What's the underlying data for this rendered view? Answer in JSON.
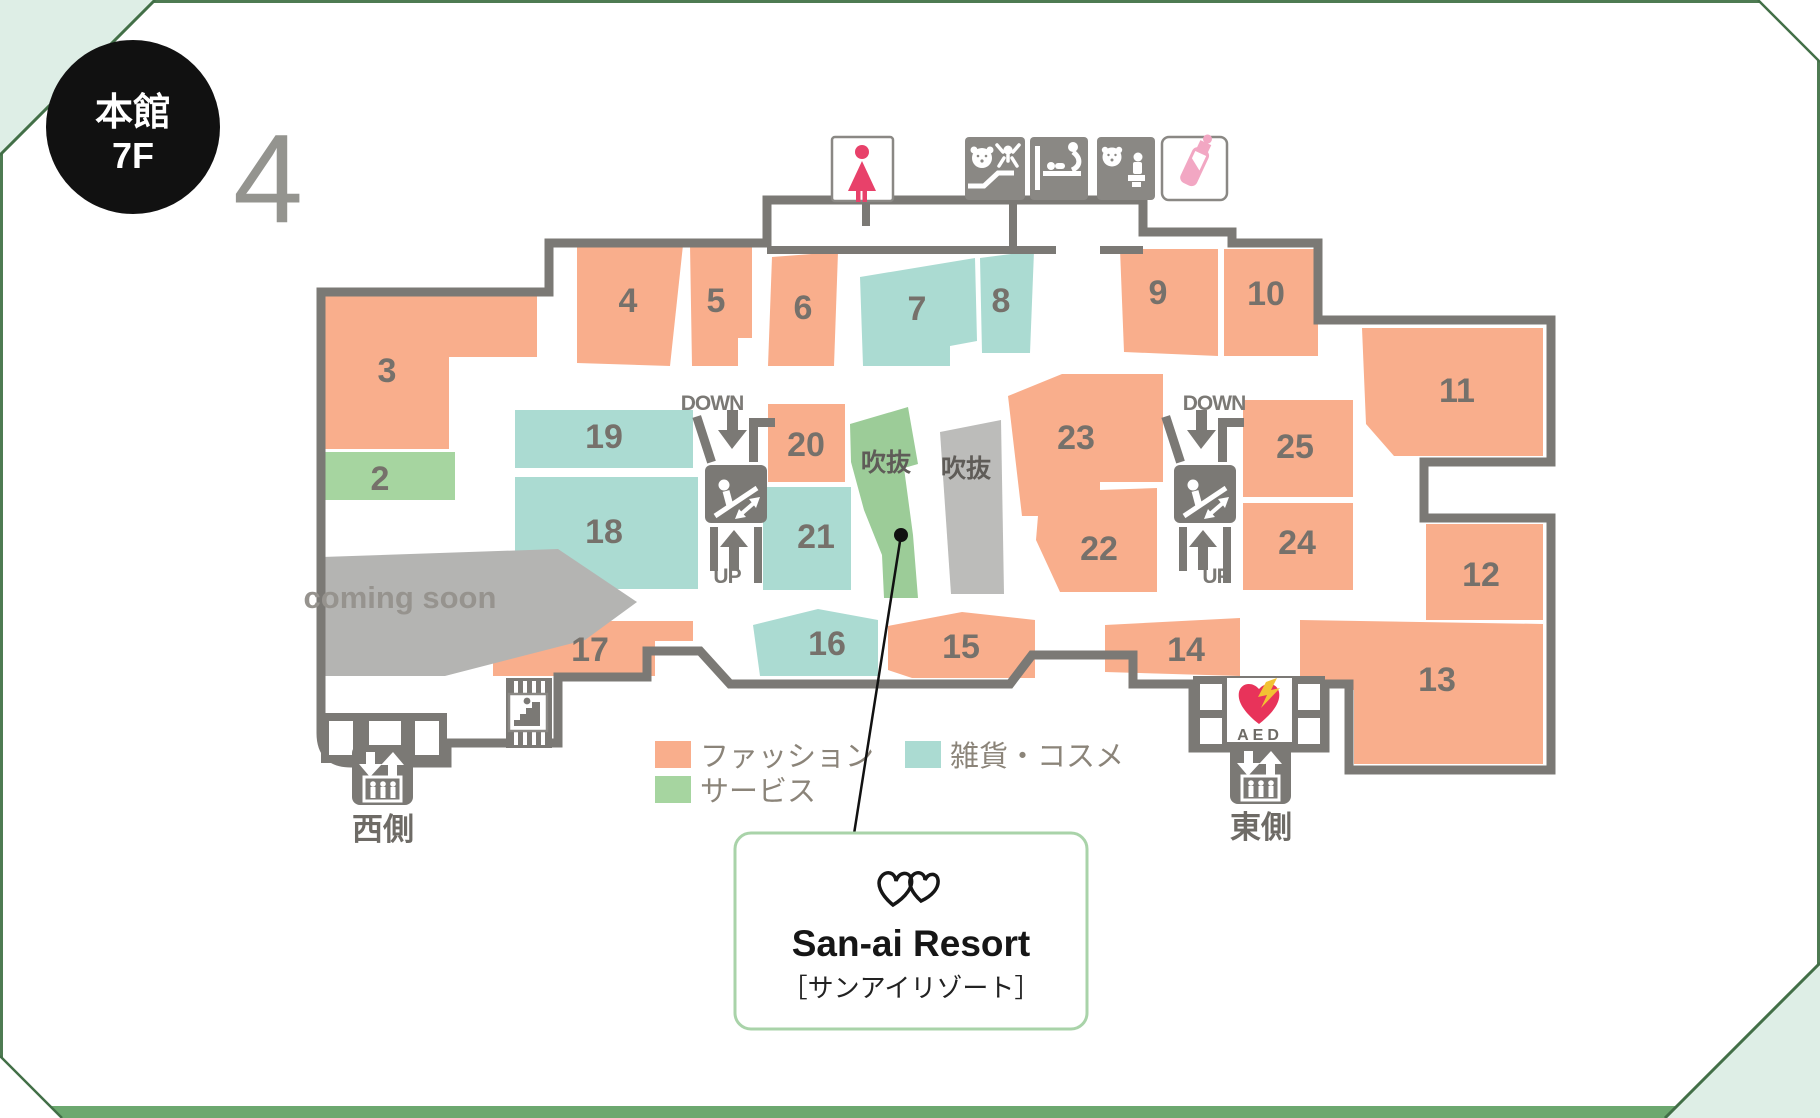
{
  "header": {
    "building": "本館",
    "floor": "7F",
    "watermark": "4"
  },
  "zones": {
    "z2": "2",
    "z3": "3",
    "z4": "4",
    "z5": "5",
    "z6": "6",
    "z7": "7",
    "z8": "8",
    "z9": "9",
    "z10": "10",
    "z11": "11",
    "z12": "12",
    "z13": "13",
    "z14": "14",
    "z15": "15",
    "z16": "16",
    "z17": "17",
    "z18": "18",
    "z19": "19",
    "z20": "20",
    "z21": "21",
    "z22": "22",
    "z23": "23",
    "z24": "24",
    "z25": "25"
  },
  "atrium": {
    "left": "吹抜",
    "right": "吹抜"
  },
  "escalator": {
    "down_label": "DOWN",
    "up_label": "UP"
  },
  "coming_soon": "coming soon",
  "elevators": {
    "west": "西側",
    "east": "東側"
  },
  "aed": {
    "label": "AED"
  },
  "legend": {
    "fashion": {
      "label": "ファッション",
      "color": "#F9AE8C"
    },
    "service": {
      "label": "サービス",
      "color": "#A6D5A0"
    },
    "goods": {
      "label": "雑貨・コスメ",
      "color": "#ABDBD2"
    }
  },
  "callout": {
    "name_en": "San-ai Resort",
    "name_jp": "［サンアイリゾート］"
  },
  "colors": {
    "wall": "#7B7975",
    "atrium_green": "#9CCC98",
    "area_gray": "#B7B7B5"
  },
  "icons": {
    "womens_restroom": "womens-restroom-icon",
    "kids_space": "kids-space-icon",
    "baby_changing": "baby-changing-icon",
    "child_toilet": "child-toilet-icon",
    "nursing_bottle": "nursing-bottle-icon",
    "escalator": "escalator-icon",
    "elevator": "elevator-icon",
    "stairs": "stairs-icon",
    "aed": "aed-icon"
  }
}
